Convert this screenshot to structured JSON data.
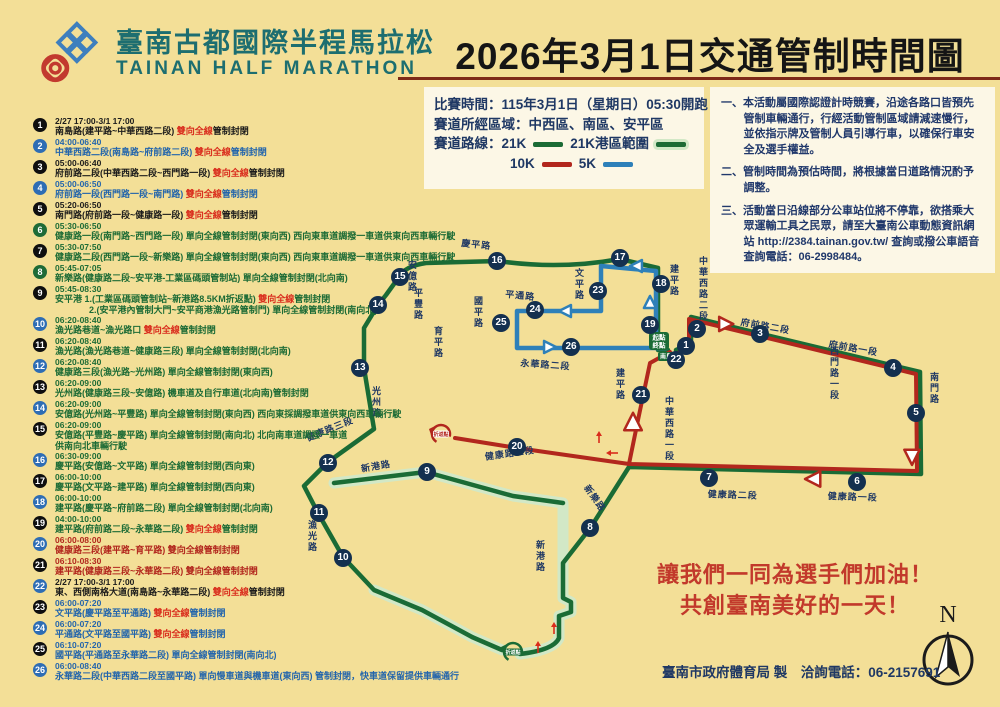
{
  "header": {
    "title_zh": "臺南古都國際半程馬拉松",
    "title_en": "TAINAN HALF MARATHON",
    "banner": "2026年3月1日交通管制時間圖"
  },
  "legend": {
    "race_time": "比賽時間：115年3月1日（星期日）05:30開跑",
    "areas": "賽道所經區域：中西區、南區、安平區",
    "routes_label": "賽道路線：",
    "r21": "21K",
    "r21_port": "21K港區範圍",
    "r10": "10K",
    "r5": "5K"
  },
  "notes": [
    "一、本活動屬國際認證計時競賽，沿途各路口皆預先管制車輛通行，行經活動管制區域請減速慢行，並依指示牌及管制人員引導行車，以確保行車安全及選手權益。",
    "二、管制時間為預估時間，將根據當日道路情況酌予調整。",
    "三、活動當日沿線部分公車站位將不停靠，欲搭乘大眾運輸工具之民眾，請至大臺南公車動態資訊網站 http://2384.tainan.gov.tw/ 查詢或撥公車語音查詢電話：06-2998484。"
  ],
  "colors": {
    "black": "#1b1b1b",
    "blue": "#2365AC",
    "green": "#1C6B35",
    "red": "#B2271D",
    "badge_black": "#0f0f0f",
    "badge_blue": "#2E6DB4",
    "badge_green": "#1E6B37",
    "route_green": "#1A6B35",
    "route_red": "#B2271D",
    "route_blue": "#2E80B9",
    "halo": "#D2E8C6",
    "accent_red": "#D92C1C",
    "navy": "#1F3864"
  },
  "closures": [
    {
      "n": 1,
      "badge": "black",
      "color": "black",
      "time": "2/27 17:00-3/1 17:00",
      "pre": "南島路(建平路~中華西路二段) ",
      "hl": "雙向全線",
      "post": "管制封閉"
    },
    {
      "n": 2,
      "badge": "blue",
      "color": "blue",
      "time": "04:00-06:40",
      "pre": "中華西路二段(南島路~府前路二段) ",
      "hl": "雙向全線",
      "post": "管制封閉"
    },
    {
      "n": 3,
      "badge": "black",
      "color": "black",
      "time": "05:00-06:40",
      "pre": "府前路二段(中華西路二段~西門路一段) ",
      "hl": "雙向全線",
      "post": "管制封閉"
    },
    {
      "n": 4,
      "badge": "blue",
      "color": "blue",
      "time": "05:00-06:50",
      "pre": "府前路一段(西門路一段~南門路) ",
      "hl": "雙向全線",
      "post": "管制封閉"
    },
    {
      "n": 5,
      "badge": "black",
      "color": "black",
      "time": "05:20-06:50",
      "pre": "南門路(府前路一段~健康路一段) ",
      "hl": "雙向全線",
      "post": "管制封閉"
    },
    {
      "n": 6,
      "badge": "green",
      "color": "green",
      "time": "05:30-06:50",
      "pre": "健康路一段(南門路~西門路一段) 單向全線管制封閉(東向西) 西向東車道調撥一車道供東向西車輛行駛",
      "hl": "",
      "post": ""
    },
    {
      "n": 7,
      "badge": "black",
      "color": "green",
      "time": "05:30-07:50",
      "pre": "健康路二段(西門路一段~新樂路) 單向全線管制封閉(東向西) 西向東車道調撥一車道供東向西車輛行駛",
      "hl": "",
      "post": ""
    },
    {
      "n": 8,
      "badge": "green",
      "color": "green",
      "time": "05:45-07:05",
      "pre": "新樂路(健康路二段~安平港-工業區碼頭管制站) 單向全線管制封閉(北向南)",
      "hl": "",
      "post": ""
    },
    {
      "n": 9,
      "badge": "black",
      "color": "green",
      "time": "05:45-08:30",
      "pre": "安平港 1.(工業區碼頭管制站~新港路8.5KM折返點) ",
      "hl": "雙向全線",
      "post": "管制封閉",
      "line2": "2.(安平港內管制大門~安平商港漁光路管制門) 單向全線管制封閉(南向北)",
      "ind": 34
    },
    {
      "n": 10,
      "badge": "blue",
      "color": "green",
      "time": "06:20-08:40",
      "pre": "漁光路巷道~漁光路口 ",
      "hl": "雙向全線",
      "post": "管制封閉"
    },
    {
      "n": 11,
      "badge": "black",
      "color": "green",
      "time": "06:20-08:40",
      "pre": "漁光路(漁光路巷道~健康路三段) 單向全線管制封閉(北向南)",
      "hl": "",
      "post": ""
    },
    {
      "n": 12,
      "badge": "blue",
      "color": "green",
      "time": "06:20-08:40",
      "pre": "健康路三段(漁光路~光州路) 單向全線管制封閉(東向西)",
      "hl": "",
      "post": ""
    },
    {
      "n": 13,
      "badge": "black",
      "color": "green",
      "time": "06:20-09:00",
      "pre": "光州路(健康路三段~安億路) 機車道及自行車道(北向南)管制封閉",
      "hl": "",
      "post": ""
    },
    {
      "n": 14,
      "badge": "blue",
      "color": "green",
      "time": "06:20-09:00",
      "pre": "安億路(光州路~平豐路) 單向全線管制封閉(東向西) 西向東採調撥車道供東向西車輛行駛",
      "hl": "",
      "post": ""
    },
    {
      "n": 15,
      "badge": "black",
      "color": "green",
      "time": "06:20-09:00",
      "pre": "安億路(平豐路~慶平路) 單向全線管制封閉(南向北) 北向南車道調撥一車道",
      "hl": "",
      "post": "",
      "line2": "供南向北車輛行駛",
      "ind": 0
    },
    {
      "n": 16,
      "badge": "blue",
      "color": "green",
      "time": "06:30-09:00",
      "pre": "慶平路(安億路~文平路) 單向全線管制封閉(西向東)",
      "hl": "",
      "post": ""
    },
    {
      "n": 17,
      "badge": "black",
      "color": "green",
      "time": "06:00-10:00",
      "pre": "慶平路(文平路~建平路) 單向全線管制封閉(西向東)",
      "hl": "",
      "post": ""
    },
    {
      "n": 18,
      "badge": "blue",
      "color": "green",
      "time": "06:00-10:00",
      "pre": "建平路(慶平路~府前路二段) 單向全線管制封閉(北向南)",
      "hl": "",
      "post": ""
    },
    {
      "n": 19,
      "badge": "black",
      "color": "green",
      "time": "04:00-10:00",
      "pre": "建平路(府前路二段~永華路二段) ",
      "hl": "雙向全線",
      "post": "管制封閉"
    },
    {
      "n": 20,
      "badge": "blue",
      "color": "red",
      "time": "06:00-08:00",
      "pre": "健康路三段(建平路~育平路) 雙向全線管制封閉",
      "hl": "",
      "post": ""
    },
    {
      "n": 21,
      "badge": "black",
      "color": "red",
      "time": "06:10-08:30",
      "pre": "建平路(健康路三段~永華路二段) 雙向全線管制封閉",
      "hl": "",
      "post": ""
    },
    {
      "n": 22,
      "badge": "blue",
      "color": "black",
      "time": "2/27 17:00-3/1 17:00",
      "pre": "東、西側南格大道(南島路~永華路二段) ",
      "hl": "雙向全線",
      "post": "管制封閉"
    },
    {
      "n": 23,
      "badge": "black",
      "color": "blue",
      "time": "06:00-07:20",
      "pre": "文平路(慶平路至平通路) ",
      "hl": "雙向全線",
      "post": "管制封閉"
    },
    {
      "n": 24,
      "badge": "blue",
      "color": "blue",
      "time": "06:00-07:20",
      "pre": "平通路(文平路至國平路) ",
      "hl": "雙向全線",
      "post": "管制封閉"
    },
    {
      "n": 25,
      "badge": "black",
      "color": "blue",
      "time": "06:10-07:20",
      "pre": "國平路(平通路至永華路二段) 單向全線管制封閉(南向北)",
      "hl": "",
      "post": ""
    },
    {
      "n": 26,
      "badge": "blue",
      "color": "blue",
      "time": "06:00-08:40",
      "pre": "永華路二段(中華西路二段至國平路) 單向慢車道與機車道(東向西) 管制封閉，快車道保留提供車輛通行",
      "hl": "",
      "post": ""
    }
  ],
  "map": {
    "halos": [
      "M334,483 L426,472 L513,496 L563,503 L563,598 L571,602 L571,612 L559,616 L559,638 Q554,650 520,654",
      "M374,590 L422,610 L472,637 L502,650"
    ],
    "routes": [
      {
        "name": "route-21k-west",
        "color": "route_green",
        "w": 4.5,
        "d": "M668,350 L658,350 L658,268 L620,259 Q560,270 498,261 L426,263 Q405,266 399,277 L386,295 L378,305 L364,328 L364,368 L374,429 L328,462 L304,486 L318,513 L343,557 L374,590 L422,610 L472,637 L502,650"
      },
      {
        "name": "route-21k-east",
        "color": "route_green",
        "w": 4.5,
        "d": "M676,350 L691,344 L691,317 L920,372 L921,474 L629,467 L591,527 L563,563 L563,598 L571,602 L571,612 L559,616 L559,638 Q554,650 520,654"
      },
      {
        "name": "route-21k-port",
        "color": "route_green",
        "w": 4.5,
        "d": "M334,483 L426,472 L513,496 L563,503"
      },
      {
        "name": "route-10k",
        "color": "route_red",
        "w": 4,
        "d": "M678,353 L689,348 L689,319 L916,374 L917,471 L629,464 L517,448 L455,438"
      },
      {
        "name": "route-10k-return",
        "color": "route_red",
        "w": 4,
        "d": "M629,464 L638,420 L650,363 L670,352"
      },
      {
        "name": "route-5k",
        "color": "route_blue",
        "w": 4.5,
        "d": "M666,348 L656,348 L656,271 L601,266 L601,311 L517,311 L517,348 L666,348"
      }
    ],
    "arrows": [
      {
        "x": 650,
        "y": 303,
        "d": "up",
        "c": "route_blue",
        "s": 11
      },
      {
        "x": 637,
        "y": 266,
        "d": "left",
        "c": "route_blue",
        "s": 11
      },
      {
        "x": 566,
        "y": 311,
        "d": "left",
        "c": "route_blue",
        "s": 11
      },
      {
        "x": 549,
        "y": 347,
        "d": "right",
        "c": "route_blue",
        "s": 11
      },
      {
        "x": 725,
        "y": 324,
        "d": "right",
        "c": "route_red",
        "s": 13
      },
      {
        "x": 814,
        "y": 479,
        "d": "left",
        "c": "route_red",
        "s": 14
      },
      {
        "x": 912,
        "y": 456,
        "d": "down",
        "c": "route_red",
        "s": 14
      },
      {
        "x": 633,
        "y": 423,
        "d": "up",
        "c": "route_red",
        "s": 16
      }
    ],
    "ticks": [
      {
        "x": 599,
        "y": 437,
        "d": "up"
      },
      {
        "x": 612,
        "y": 453,
        "d": "left"
      },
      {
        "x": 538,
        "y": 647,
        "d": "up"
      },
      {
        "x": 554,
        "y": 628,
        "d": "up"
      }
    ],
    "turnarounds": [
      {
        "x": 441,
        "y": 434,
        "c": "route_red",
        "label": "折返點"
      },
      {
        "x": 513,
        "y": 652,
        "c": "route_green",
        "label": "折返點"
      }
    ],
    "start": {
      "x": 659,
      "y": 341,
      "l1": "起點",
      "l2": "終點",
      "road": "南島路"
    },
    "compass": {
      "x": 948,
      "y": 660,
      "n": "N"
    },
    "badges": [
      [
        1,
        686,
        346
      ],
      [
        2,
        697,
        329
      ],
      [
        3,
        760,
        334
      ],
      [
        4,
        893,
        368
      ],
      [
        5,
        916,
        413
      ],
      [
        6,
        857,
        482
      ],
      [
        7,
        709,
        478
      ],
      [
        8,
        590,
        528
      ],
      [
        9,
        427,
        472
      ],
      [
        10,
        343,
        558
      ],
      [
        11,
        319,
        513
      ],
      [
        12,
        328,
        463
      ],
      [
        13,
        360,
        368
      ],
      [
        14,
        378,
        305
      ],
      [
        15,
        400,
        277
      ],
      [
        16,
        497,
        261
      ],
      [
        17,
        620,
        258
      ],
      [
        18,
        661,
        284
      ],
      [
        19,
        650,
        325
      ],
      [
        20,
        517,
        447
      ],
      [
        21,
        641,
        395
      ],
      [
        22,
        676,
        360
      ],
      [
        23,
        598,
        291
      ],
      [
        24,
        535,
        310
      ],
      [
        25,
        501,
        323
      ],
      [
        26,
        571,
        347
      ]
    ],
    "roads": [
      {
        "t": "慶平路",
        "x": 462,
        "y": 236,
        "r": 6
      },
      {
        "t": "文平路",
        "x": 573,
        "y": 268,
        "v": 1
      },
      {
        "t": "平通路",
        "x": 506,
        "y": 287,
        "r": 6
      },
      {
        "t": "國平路",
        "x": 472,
        "y": 296,
        "v": 1
      },
      {
        "t": "永華路二段",
        "x": 521,
        "y": 356,
        "r": 4
      },
      {
        "t": "建平路",
        "x": 668,
        "y": 264,
        "v": 1
      },
      {
        "t": "中華西路二段",
        "x": 697,
        "y": 256,
        "v": 1
      },
      {
        "t": "建平路",
        "x": 614,
        "y": 368,
        "v": 1
      },
      {
        "t": "中華西路一段",
        "x": 663,
        "y": 396,
        "v": 1
      },
      {
        "t": "育平路",
        "x": 432,
        "y": 326,
        "v": 1
      },
      {
        "t": "安億路",
        "x": 406,
        "y": 260,
        "v": 1
      },
      {
        "t": "平豐路",
        "x": 412,
        "y": 288,
        "v": 1
      },
      {
        "t": "光州路",
        "x": 370,
        "y": 386,
        "v": 1
      },
      {
        "t": "健康路三段",
        "x": 304,
        "y": 432,
        "r": -22
      },
      {
        "t": "漁光路",
        "x": 306,
        "y": 520,
        "v": 1
      },
      {
        "t": "新港路",
        "x": 360,
        "y": 462,
        "r": -10
      },
      {
        "t": "新港路",
        "x": 534,
        "y": 540,
        "v": 1
      },
      {
        "t": "新樂路",
        "x": 592,
        "y": 482,
        "r": 55
      },
      {
        "t": "健康路三段",
        "x": 484,
        "y": 450,
        "r": -8
      },
      {
        "t": "健康路二段",
        "x": 708,
        "y": 487,
        "r": 2
      },
      {
        "t": "健康路一段",
        "x": 828,
        "y": 489,
        "r": 2
      },
      {
        "t": "西門路一段",
        "x": 828,
        "y": 346,
        "v": 1
      },
      {
        "t": "南門路",
        "x": 928,
        "y": 372,
        "v": 1
      },
      {
        "t": "府前路二段",
        "x": 742,
        "y": 315,
        "r": 10
      },
      {
        "t": "府前路一段",
        "x": 830,
        "y": 337,
        "r": 10
      }
    ]
  },
  "footer": {
    "cheer1": "讓我們一同為選手們加油！",
    "cheer2": "共創臺南美好的一天！",
    "credit": "臺南市政府體育局 製　洽詢電話：06-2157691"
  }
}
